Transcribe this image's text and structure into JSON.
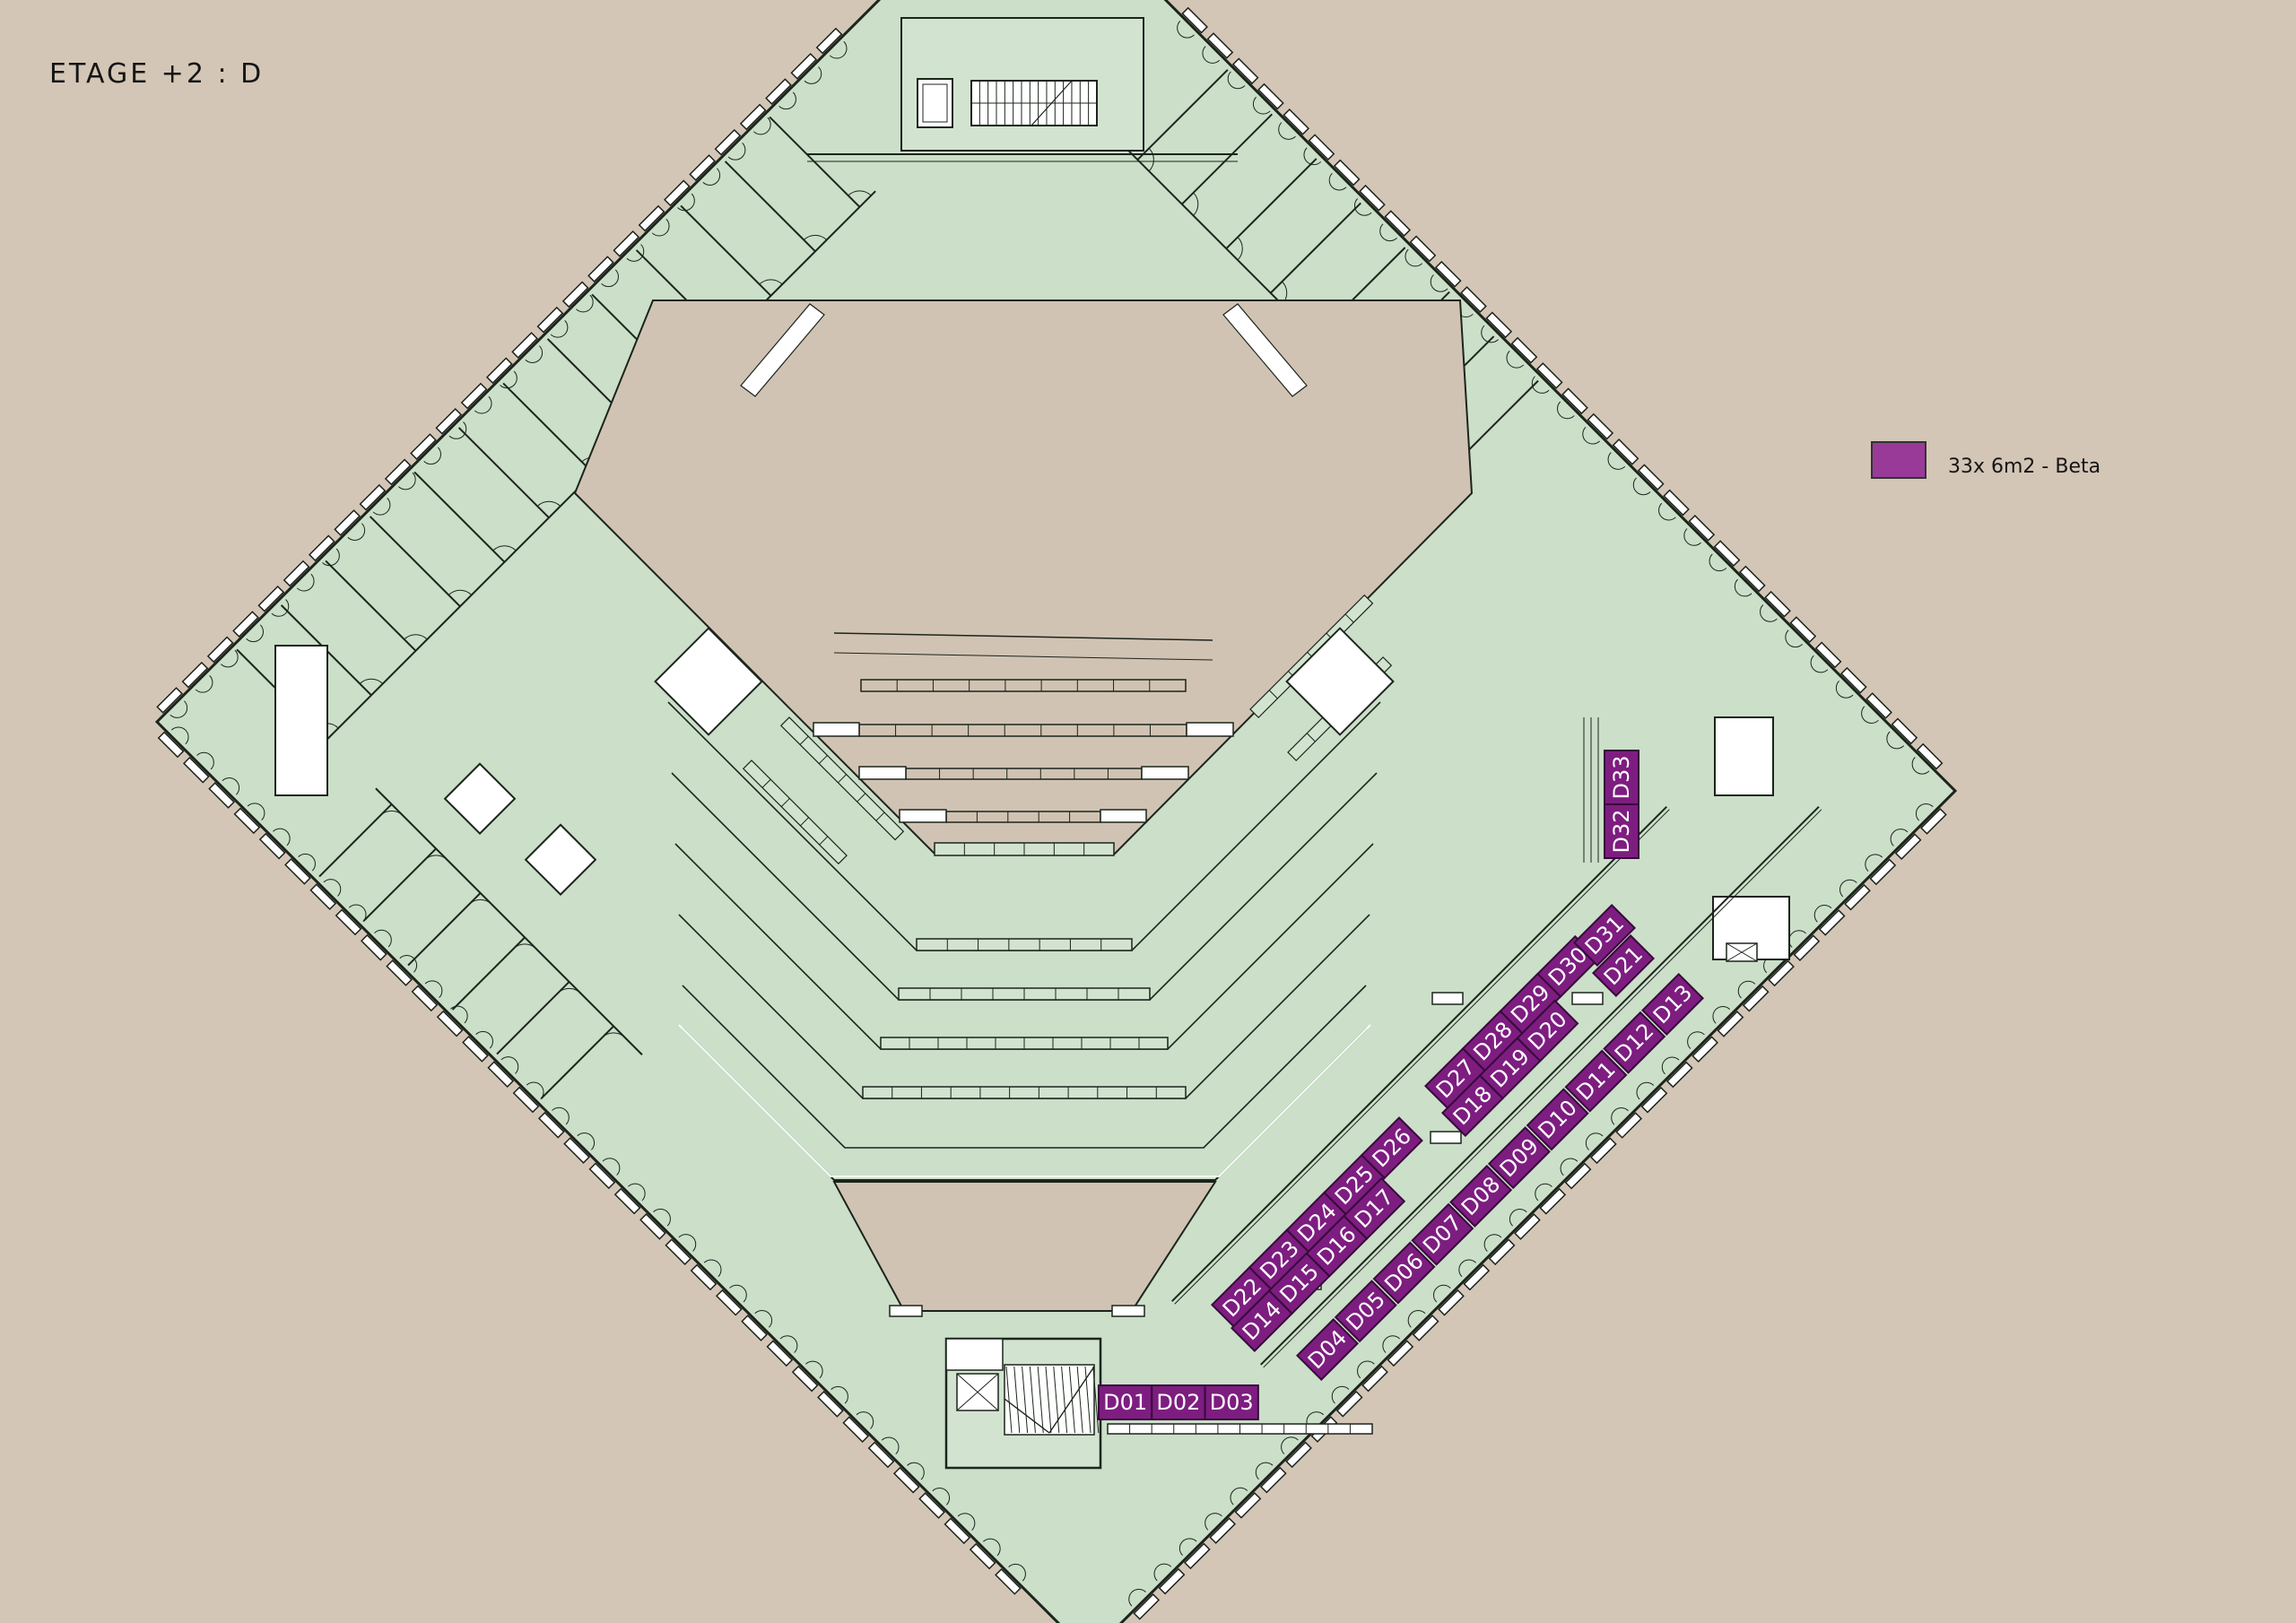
{
  "title": "ETAGE +2 : D",
  "legend": {
    "swatch_color": "#993A99",
    "label": "33x 6m2 - Beta"
  },
  "palette": {
    "background": "#D4C6B6",
    "floor": "#CBDFC9",
    "floor_light": "#D2E4D0",
    "wall": "#1C241C",
    "void": "#D1C3B3",
    "white": "#FFFFFF",
    "booth_fill": "#7D1D80",
    "booth_stroke": "#38093B",
    "booth_text": "#FFFFFF",
    "text_color": "#151515"
  },
  "booths": {
    "bottom_row": [
      "D01",
      "D02",
      "D03"
    ],
    "outer_strip": [
      "D04",
      "D05",
      "D06",
      "D07",
      "D08",
      "D09",
      "D10",
      "D11",
      "D12",
      "D13"
    ],
    "inner_upper_groups": [
      [
        "D22",
        "D23",
        "D24",
        "D25",
        "D26"
      ],
      [
        "D27",
        "D28",
        "D29",
        "D30"
      ],
      [
        "D31"
      ]
    ],
    "inner_lower_groups": [
      [
        "D14",
        "D15",
        "D16",
        "D17"
      ],
      [
        "D18",
        "D19",
        "D20"
      ],
      [
        "D21"
      ]
    ],
    "vertical_stack": [
      "D33",
      "D32"
    ]
  }
}
